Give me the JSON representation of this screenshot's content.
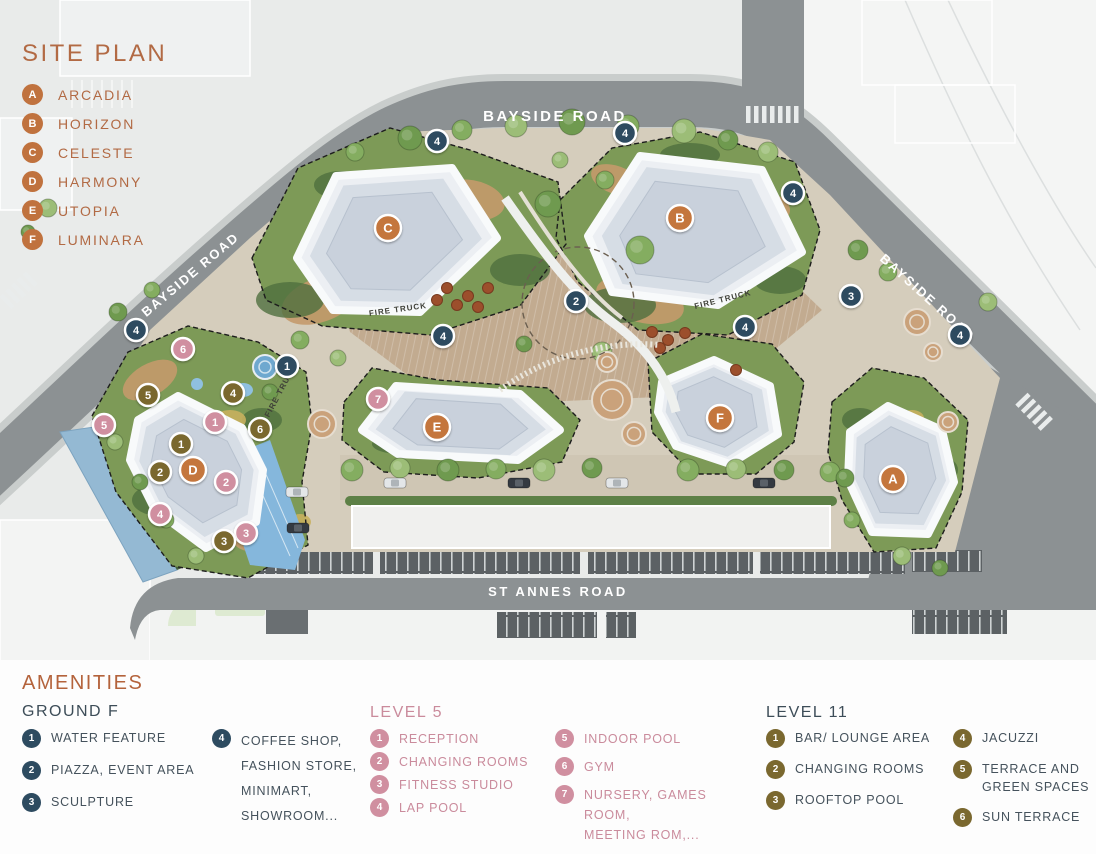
{
  "site_plan": {
    "title": "SITE PLAN",
    "accent_color": "#b26a44",
    "badge_color": "#c0723e",
    "items": [
      {
        "letter": "A",
        "name": "ARCADIA"
      },
      {
        "letter": "B",
        "name": "HORIZON"
      },
      {
        "letter": "C",
        "name": "CELESTE"
      },
      {
        "letter": "D",
        "name": "HARMONY"
      },
      {
        "letter": "E",
        "name": "UTOPIA"
      },
      {
        "letter": "F",
        "name": "LUMINARA"
      }
    ]
  },
  "map": {
    "road_labels": {
      "bayside_top": "BAYSIDE ROAD",
      "bayside_left": "BAYSIDE ROAD",
      "bayside_right": "BAYSIDE ROAD",
      "st_annes": "ST ANNES ROAD"
    },
    "fire_truck_label": "FIRE TRUCK",
    "marker_groups": [
      {
        "group": "buildings",
        "color": "#c4763e",
        "r": 13,
        "font": 13,
        "items": [
          {
            "label": "A",
            "x": 893,
            "y": 479
          },
          {
            "label": "B",
            "x": 680,
            "y": 218
          },
          {
            "label": "C",
            "x": 388,
            "y": 228
          },
          {
            "label": "D",
            "x": 193,
            "y": 470
          },
          {
            "label": "E",
            "x": 437,
            "y": 427
          },
          {
            "label": "F",
            "x": 720,
            "y": 418
          }
        ]
      },
      {
        "group": "ground",
        "color": "#2d4b60",
        "r": 11,
        "font": 11,
        "items": [
          {
            "label": "1",
            "x": 287,
            "y": 366
          },
          {
            "label": "2",
            "x": 576,
            "y": 301
          },
          {
            "label": "3",
            "x": 851,
            "y": 296
          },
          {
            "label": "4",
            "x": 136,
            "y": 330
          },
          {
            "label": "4",
            "x": 437,
            "y": 141
          },
          {
            "label": "4",
            "x": 625,
            "y": 133
          },
          {
            "label": "4",
            "x": 793,
            "y": 193
          },
          {
            "label": "4",
            "x": 745,
            "y": 327
          },
          {
            "label": "4",
            "x": 443,
            "y": 336
          },
          {
            "label": "4",
            "x": 960,
            "y": 335
          }
        ]
      },
      {
        "group": "level5",
        "color": "#d08fa0",
        "r": 11,
        "font": 11,
        "items": [
          {
            "label": "1",
            "x": 215,
            "y": 422
          },
          {
            "label": "2",
            "x": 226,
            "y": 482
          },
          {
            "label": "3",
            "x": 246,
            "y": 533
          },
          {
            "label": "4",
            "x": 160,
            "y": 514
          },
          {
            "label": "5",
            "x": 104,
            "y": 425
          },
          {
            "label": "6",
            "x": 183,
            "y": 349
          },
          {
            "label": "7",
            "x": 378,
            "y": 399
          }
        ]
      },
      {
        "group": "level11",
        "color": "#7a682f",
        "r": 11,
        "font": 11,
        "items": [
          {
            "label": "1",
            "x": 181,
            "y": 444
          },
          {
            "label": "2",
            "x": 160,
            "y": 472
          },
          {
            "label": "3",
            "x": 224,
            "y": 541
          },
          {
            "label": "4",
            "x": 233,
            "y": 393
          },
          {
            "label": "5",
            "x": 148,
            "y": 395
          },
          {
            "label": "6",
            "x": 260,
            "y": 429
          }
        ]
      }
    ]
  },
  "amenities": {
    "title": "AMENITIES",
    "accent_color": "#b4633c",
    "groups": [
      {
        "id": "ground",
        "heading": "GROUND F",
        "heading_color": "#3d4d58",
        "badge_color": "#2d4b60",
        "text_color": "#45525c",
        "columns": [
          [
            {
              "n": "1",
              "lines": [
                "WATER FEATURE"
              ]
            },
            {
              "n": "2",
              "lines": [
                "PIAZZA, EVENT AREA"
              ]
            },
            {
              "n": "3",
              "lines": [
                "SCULPTURE"
              ]
            }
          ],
          [
            {
              "n": "4",
              "lines": [
                "COFFEE SHOP,",
                "FASHION STORE,",
                "MINIMART,",
                "SHOWROOM..."
              ]
            }
          ]
        ]
      },
      {
        "id": "level5",
        "heading": "LEVEL 5",
        "heading_color": "#ca8b9c",
        "badge_color": "#d08fa0",
        "text_color": "#ca8b9c",
        "columns": [
          [
            {
              "n": "1",
              "lines": [
                "RECEPTION"
              ]
            },
            {
              "n": "2",
              "lines": [
                "CHANGING ROOMS"
              ]
            },
            {
              "n": "3",
              "lines": [
                "FITNESS STUDIO"
              ]
            },
            {
              "n": "4",
              "lines": [
                "LAP POOL"
              ]
            }
          ],
          [
            {
              "n": "5",
              "lines": [
                "INDOOR POOL"
              ]
            },
            {
              "n": "6",
              "lines": [
                "GYM"
              ]
            },
            {
              "n": "7",
              "lines": [
                "NURSERY, GAMES ROOM,",
                "MEETING ROM,..."
              ]
            }
          ]
        ]
      },
      {
        "id": "level11",
        "heading": "LEVEL 11",
        "heading_color": "#3d4d58",
        "badge_color": "#7a682f",
        "text_color": "#45525c",
        "columns": [
          [
            {
              "n": "1",
              "lines": [
                "BAR/ LOUNGE AREA"
              ]
            },
            {
              "n": "2",
              "lines": [
                "CHANGING ROOMS"
              ]
            },
            {
              "n": "3",
              "lines": [
                "ROOFTOP POOL"
              ]
            }
          ],
          [
            {
              "n": "4",
              "lines": [
                "JACUZZI"
              ]
            },
            {
              "n": "5",
              "lines": [
                "TERRACE AND",
                "GREEN SPACES"
              ]
            },
            {
              "n": "6",
              "lines": [
                "SUN TERRACE"
              ]
            }
          ]
        ]
      }
    ]
  }
}
